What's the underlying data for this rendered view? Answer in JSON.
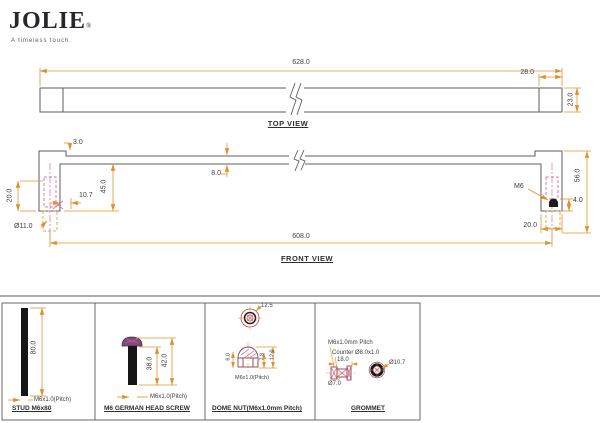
{
  "logo": {
    "name": "JOLIE",
    "reg": "®",
    "tagline": "A timeless touch."
  },
  "top_view": {
    "label": "TOP VIEW",
    "dim_length": "628.0",
    "dim_end_cap": "28.0",
    "dim_height": "23.0"
  },
  "front_view": {
    "label": "FRONT VIEW",
    "dim_step": "3.0",
    "dim_bar_thickness": "8.0",
    "dim_drop": "45.0",
    "dim_offset": "10.7",
    "dim_left_depth": "20.0",
    "dim_hole_dia": "Ø11.0",
    "dim_span": "608.0",
    "thread_label": "M6",
    "dim_nut_height": "4.0",
    "dim_total_height": "56.0",
    "dim_leg_width": "20.0"
  },
  "details": {
    "stud": {
      "title": "STUD M6x80",
      "dim_length": "80.0",
      "pitch": "M6x1.0(Pitch)"
    },
    "screw": {
      "title": "M6 GERMAN HEAD SCREW",
      "dim_shaft": "38.0",
      "dim_total": "42.0",
      "pitch": "M6x1.0(Pitch)"
    },
    "dome_nut": {
      "title": "DOME NUT(M6x1.0mm Pitch)",
      "dim_dia": "12.5",
      "dim_width": "6.0",
      "dim_body": "7.8",
      "dim_height": "12.0",
      "pitch": "M6x1.0(Pitch)"
    },
    "grommet": {
      "title": "GROMMET",
      "pitch": "M6x1.0mm Pitch",
      "counter": "Counter Ø8.0x1.0",
      "dim_width": "18.0",
      "dim_small_dia": "Ø7.0",
      "dim_outer_dia": "Ø10.7"
    }
  },
  "colors": {
    "outline": "#5E5E5E",
    "dimension": "#E0912F",
    "hidden_line": "#D4549A",
    "accent_red": "#C03A3A",
    "logo": "#262630"
  }
}
